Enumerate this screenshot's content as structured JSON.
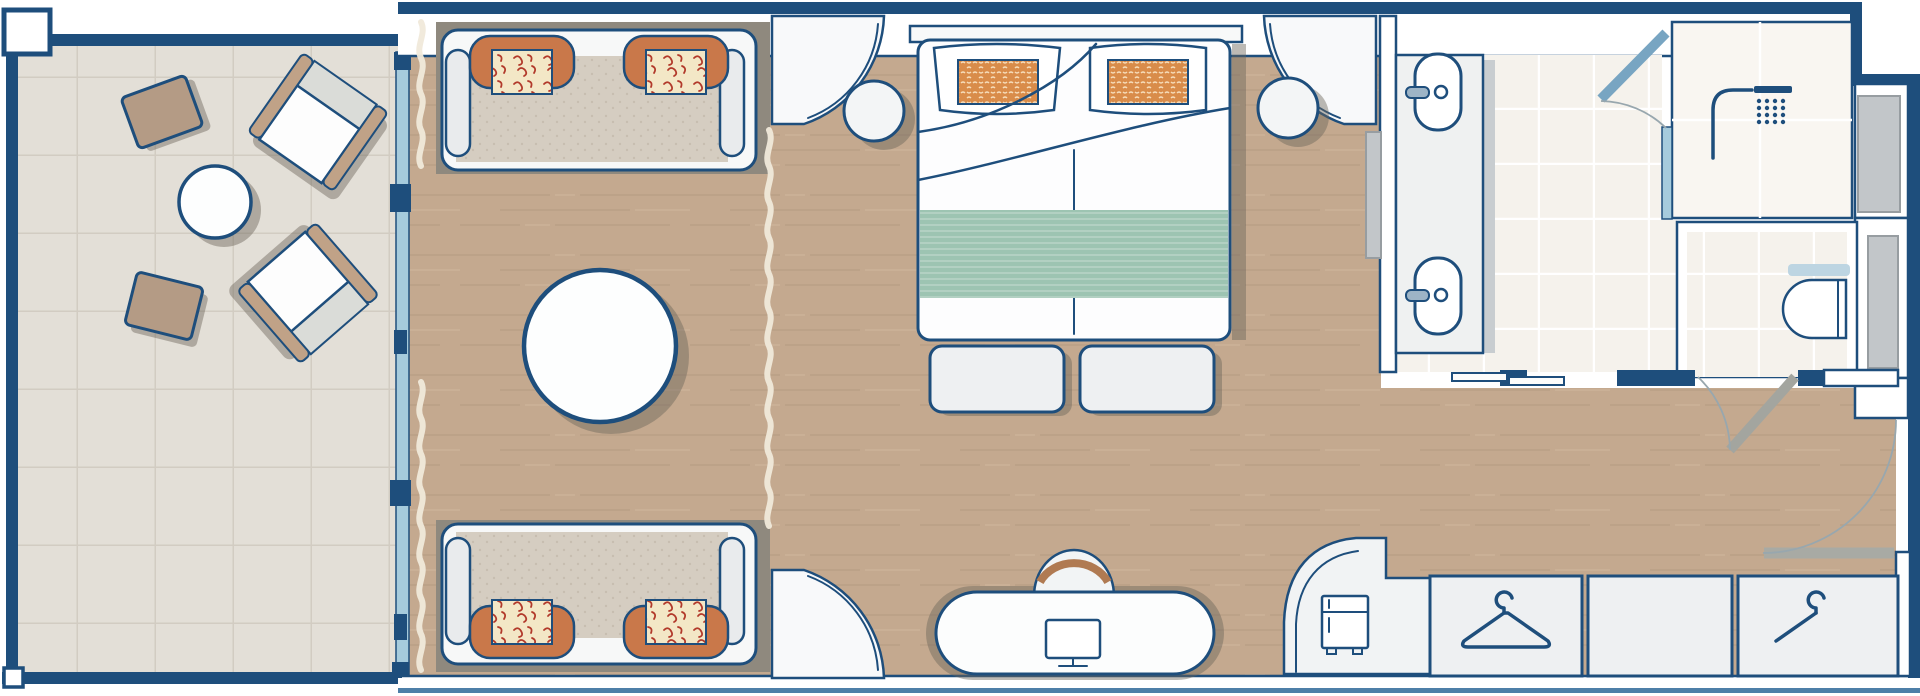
{
  "document": {
    "type": "architectural-floor-plan",
    "subject": "suite cabin with balcony, living area, bedroom, bathroom, wardrobe and entry",
    "orientation": "landscape",
    "has_text_labels": false
  },
  "colors": {
    "page-bg": "#ffffff",
    "wall-outline": "#1e4e7c",
    "wall-fill": "#ffffff",
    "accent-blue": "#4d7fa8",
    "glass": "#a6cbdc",
    "wood-floor": "#c4a98f",
    "wood-plank-line": "#b0947a",
    "balcony-tile": "#e3dfd7",
    "balcony-tile-line": "#d2ccc2",
    "bath-tile": "#f5f2ec",
    "furniture-white": "#fbfcfd",
    "furniture-gray": "#eef0f2",
    "seat-beige": "#d5cdc1",
    "sofa-backing": "#8f897e",
    "orange": "#c9784a",
    "pillow-orange": "#d98c4a",
    "cushion-cream": "#f3e7c6",
    "cushion-red": "#b23a2b",
    "teal": "#9dc4b2",
    "tan": "#c0a287",
    "table-tan": "#b49b85",
    "panel-gray": "#c2c6c9",
    "door-gray": "#a8aaa4",
    "shower-door-blue": "#78a5c2",
    "swing-arc": "#98a7ae",
    "curtain": "#f0e9da",
    "shadow-color": "rgba(108,101,90,0.45)"
  },
  "rooms": [
    {
      "id": "balcony",
      "name": "Balcony",
      "floor": "tile",
      "furniture": [
        "lounge chair",
        "lounge chair",
        "side table",
        "side table",
        "round table"
      ]
    },
    {
      "id": "living-area",
      "name": "Living area",
      "floor": "wood",
      "furniture": [
        "sofa with two cushion sets",
        "sofa with two cushion sets",
        "round ottoman table",
        "window curtain",
        "room divider curtain"
      ]
    },
    {
      "id": "bedroom",
      "name": "Bedroom",
      "floor": "wood",
      "furniture": [
        "double bed",
        "pillow with orange cushion",
        "pillow with orange cushion",
        "teal bed runner",
        "round nightstand",
        "round nightstand",
        "foot bench",
        "foot bench",
        "wall panel"
      ]
    },
    {
      "id": "work-area",
      "name": "Desk area",
      "floor": "wood",
      "furniture": [
        "curved desk",
        "chair",
        "monitor"
      ]
    },
    {
      "id": "bathroom",
      "name": "Bathroom",
      "floor": "tile",
      "furniture": [
        "vanity counter",
        "sink",
        "sink",
        "sliding door panels",
        "shower room",
        "shower head",
        "glass shower door",
        "toilet room",
        "toilet",
        "towel shelf"
      ]
    },
    {
      "id": "wardrobe-entry",
      "name": "Wardrobe / entry",
      "floor": "wood",
      "furniture": [
        "curved minibar cabinet",
        "mini fridge",
        "closet section with hanger",
        "closet section",
        "closet section with hanger",
        "entrance door",
        "wc door"
      ]
    }
  ],
  "icons": [
    "shower-head-icon",
    "monitor-icon",
    "mini-fridge-icon",
    "clothes-hanger-icon",
    "clothes-hanger-icon"
  ]
}
